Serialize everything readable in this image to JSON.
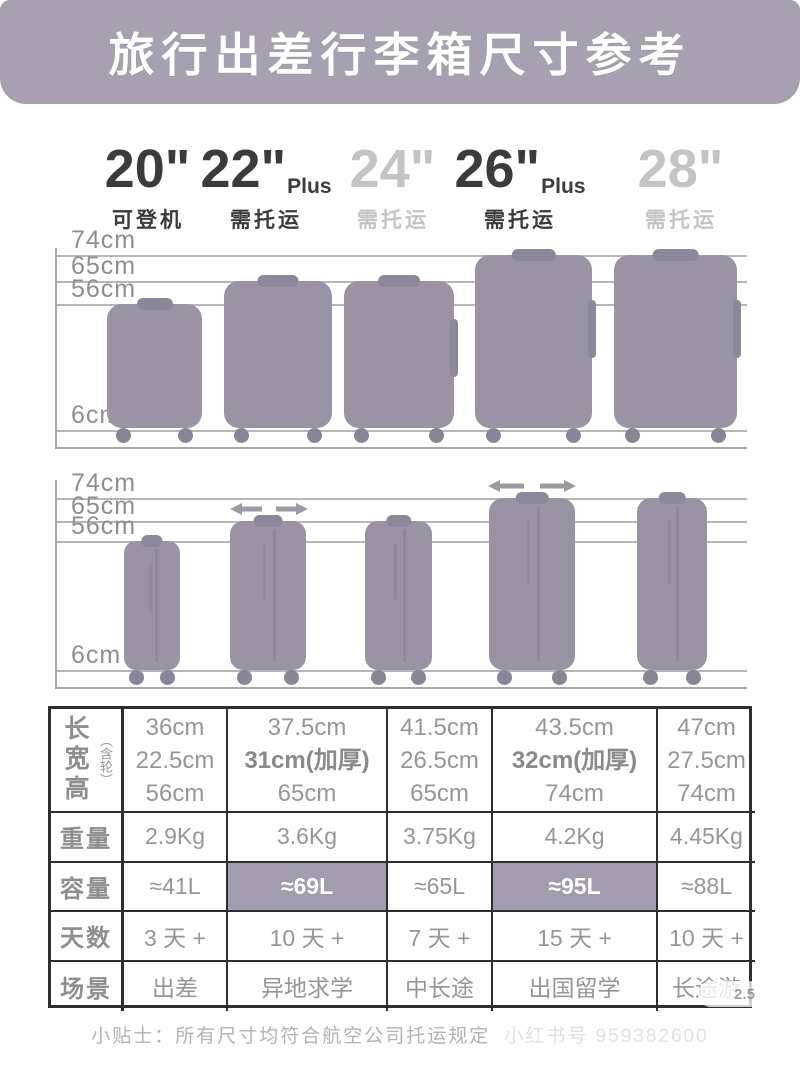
{
  "title": "旅行出差行李箱尺寸参考",
  "colors": {
    "banner": "#a8a0b1",
    "luggage": "#9b93a4",
    "luggage_dark": "#8e8699",
    "capacity_highlight": "#a49bae",
    "dark_text": "#3b3b3b",
    "light_text": "#c4c3c7",
    "table_text": "#979599"
  },
  "sizes": [
    {
      "num": "20\"",
      "plus": "",
      "label": "可登机"
    },
    {
      "num": "22\"",
      "plus": "Plus",
      "label": "需托运"
    },
    {
      "num": "24\"",
      "plus": "",
      "label": "需托运"
    },
    {
      "num": "26\"",
      "plus": "Plus",
      "label": "需托运"
    },
    {
      "num": "28\"",
      "plus": "",
      "label": "需托运"
    }
  ],
  "figure": {
    "ticks": [
      "74cm",
      "65cm",
      "56cm",
      "6cm"
    ],
    "front_view_heights_cm": [
      56,
      65,
      65,
      74,
      74
    ],
    "side_view_heights_cm": [
      56,
      65,
      65,
      74,
      74
    ],
    "expanded_width_sizes": [
      "22\" Plus",
      "26\" Plus"
    ]
  },
  "table": {
    "header_col": {
      "dims_main": "长宽高",
      "dims_sub": "（含轮）",
      "weight": "重量",
      "capacity": "容量",
      "days": "天数",
      "scene": "场景"
    },
    "dims": [
      {
        "l": "36cm",
        "w": "22.5cm",
        "h": "56cm"
      },
      {
        "l": "37.5cm",
        "w": "31cm(加厚)",
        "h": "65cm"
      },
      {
        "l": "41.5cm",
        "w": "26.5cm",
        "h": "65cm"
      },
      {
        "l": "43.5cm",
        "w": "32cm(加厚)",
        "h": "74cm"
      },
      {
        "l": "47cm",
        "w": "27.5cm",
        "h": "74cm"
      }
    ],
    "weight": [
      "2.9Kg",
      "3.6Kg",
      "3.75Kg",
      "4.2Kg",
      "4.45Kg"
    ],
    "capacity": [
      "≈41L",
      "≈69L",
      "≈65L",
      "≈95L",
      "≈88L"
    ],
    "days": [
      "3 天 +",
      "10 天 +",
      "7 天 +",
      "15 天 +",
      "10 天 +"
    ],
    "scene": [
      "出差",
      "异地求学",
      "中长途",
      "出国留学",
      "长途游"
    ]
  },
  "footnote": "小贴士：所有尺寸均符合航空公司托运规定",
  "watermark": "小红书号 959382600",
  "badge": "2.5"
}
